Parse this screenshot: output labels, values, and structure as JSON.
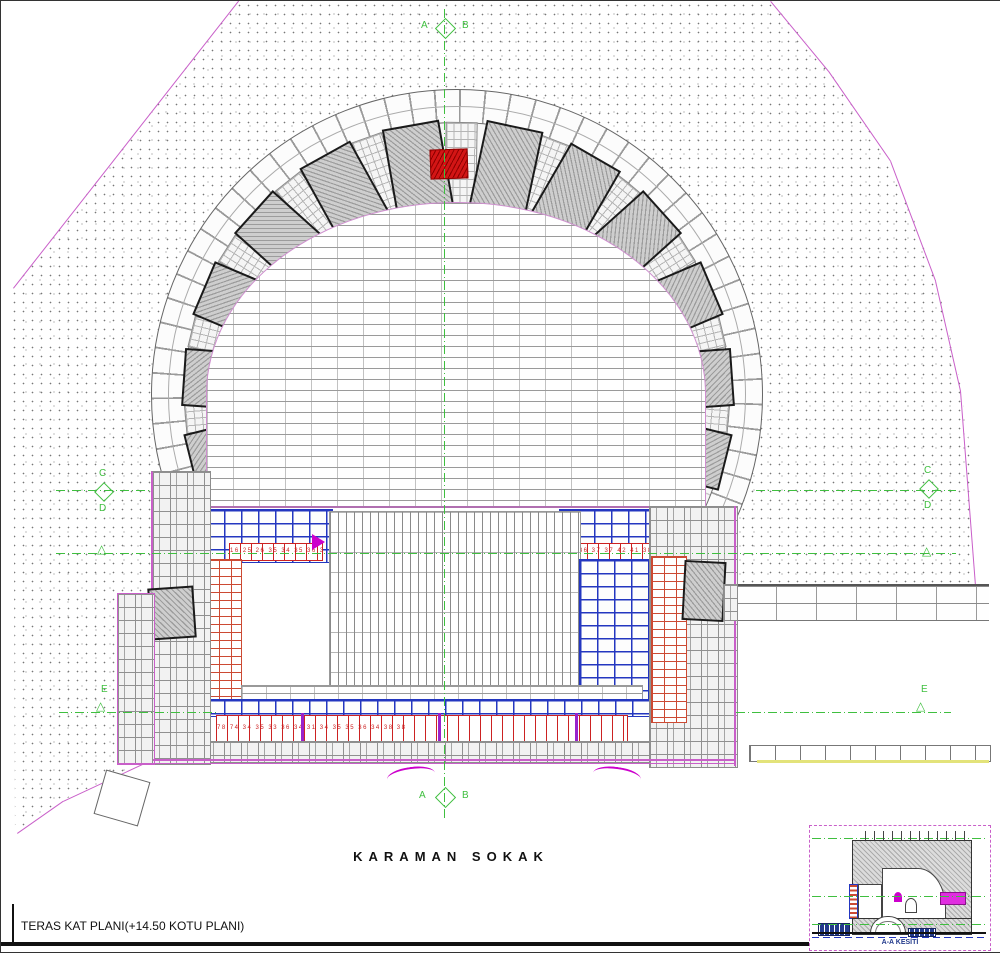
{
  "title_block": {
    "title": "TERAS KAT PLANI(+14.50 KOTU PLANI)"
  },
  "street": {
    "name": "KARAMAN  SOKAK"
  },
  "markers": {
    "a": "A",
    "b": "B",
    "c": "C",
    "d": "D",
    "e": "E"
  },
  "inset": {
    "label": "A-A KESİTİ"
  },
  "stone_numbers": {
    "left_row": "16 25 26 35 34 35 36 35 36 32 35",
    "right_row": "34 36 37 37 42 41 38 36 77 36",
    "bottom_row": "78 74 34 35 33 36 34 31 34 35 35 36 34 38 38"
  },
  "colors": {
    "magenta": "#c95fc9",
    "arrow": "#cc00cc",
    "green": "#3fbf3f",
    "red": "#cc2222",
    "brickred": "#cc4a33",
    "blue": "#2336c0",
    "purple": "#9922cc",
    "yellow": "#e3e37a"
  }
}
